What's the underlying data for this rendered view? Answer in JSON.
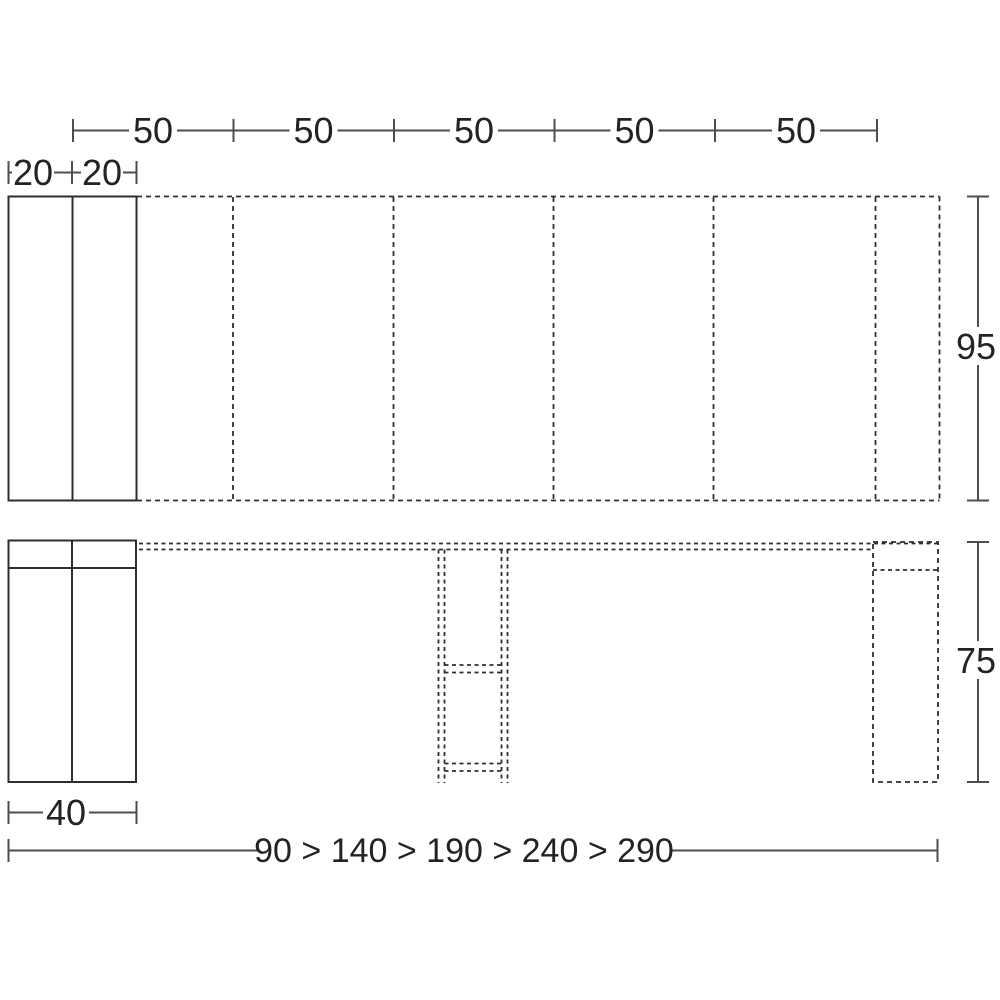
{
  "drawing": {
    "description_labels": {
      "top_dimension_row": {
        "segment_labels": [
          "50",
          "50",
          "50",
          "50",
          "50"
        ]
      },
      "panel_dimension_row": {
        "labels": [
          "20",
          "20"
        ]
      },
      "depth_label": "95",
      "height_label": "75",
      "closed_width_label": "40",
      "extension_sequence_label": "90 > 140 > 190 > 240 > 290"
    }
  },
  "colors": {
    "drawing_line": "#2e2e2e",
    "dimension_line": "#4d4d4d",
    "label_text": "#232323",
    "background": "#ffffff"
  }
}
